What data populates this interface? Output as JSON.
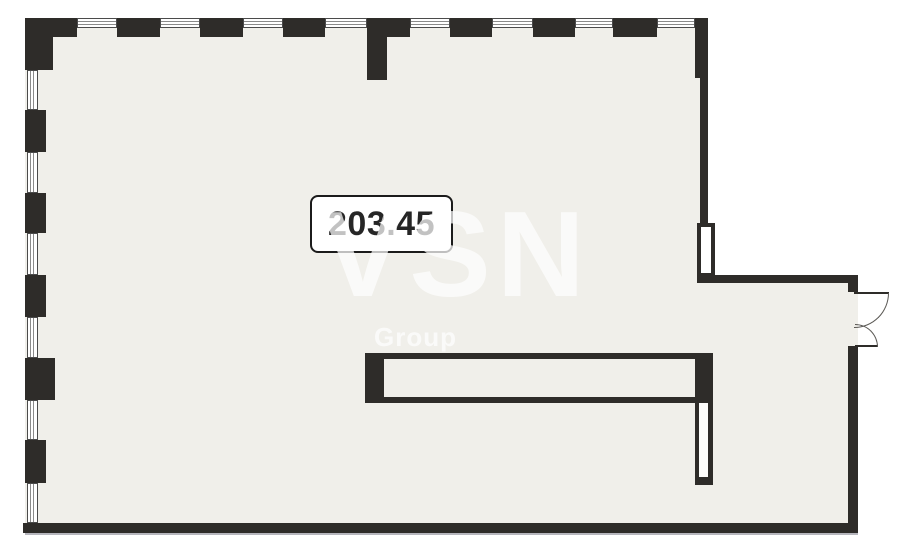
{
  "plan": {
    "area_label": "203.45",
    "watermark": {
      "line1": "VSN",
      "line2": "Group"
    },
    "colors": {
      "wall": "#2e2c29",
      "floor": "#f0efea",
      "outside": "#ffffff",
      "window_frame": "#4b4b4b",
      "window_line": "#8a8a8a",
      "shadow_line": "#b6b6bd",
      "arc_line": "#5a5854",
      "label_border": "#1b1b1b",
      "label_text": "#262626",
      "watermark": "#ffffff"
    },
    "floor_rects": [
      [
        25,
        18,
        683,
        515
      ],
      [
        697,
        275,
        161,
        258
      ]
    ],
    "wall_rects": [
      [
        25,
        18,
        52,
        19
      ],
      [
        25,
        18,
        28,
        52
      ],
      [
        117,
        18,
        43,
        19
      ],
      [
        200,
        18,
        43,
        19
      ],
      [
        283,
        18,
        42,
        19
      ],
      [
        367,
        18,
        43,
        19
      ],
      [
        367,
        37,
        20,
        43
      ],
      [
        450,
        18,
        42,
        19
      ],
      [
        533,
        18,
        42,
        19
      ],
      [
        613,
        18,
        44,
        19
      ],
      [
        695,
        18,
        13,
        60
      ],
      [
        700,
        78,
        8,
        146
      ],
      [
        25,
        110,
        21,
        42
      ],
      [
        25,
        193,
        21,
        40
      ],
      [
        25,
        275,
        21,
        42
      ],
      [
        25,
        358,
        30,
        42
      ],
      [
        25,
        440,
        21,
        43
      ],
      [
        697,
        275,
        161,
        8
      ],
      [
        848,
        275,
        10,
        17
      ],
      [
        848,
        346,
        10,
        187
      ],
      [
        23,
        523,
        835,
        10
      ],
      [
        365,
        353,
        19,
        50
      ],
      [
        695,
        353,
        18,
        50
      ]
    ],
    "windows_top": [
      [
        77,
        18,
        40,
        10
      ],
      [
        160,
        18,
        40,
        10
      ],
      [
        243,
        18,
        40,
        10
      ],
      [
        325,
        18,
        42,
        10
      ],
      [
        410,
        18,
        40,
        10
      ],
      [
        492,
        18,
        41,
        10
      ],
      [
        575,
        18,
        38,
        10
      ],
      [
        657,
        18,
        38,
        10
      ]
    ],
    "windows_left": [
      [
        27,
        70,
        11,
        40
      ],
      [
        27,
        152,
        11,
        41
      ],
      [
        27,
        233,
        11,
        42
      ],
      [
        27,
        317,
        11,
        41
      ],
      [
        27,
        400,
        11,
        40
      ],
      [
        27,
        483,
        11,
        40
      ]
    ],
    "door_jamb_rect": [
      697,
      223,
      18,
      54
    ],
    "counter_bar_rect": [
      365,
      353,
      348,
      50
    ],
    "pillar_rect": [
      695,
      403,
      18,
      82
    ],
    "shadow_rect": [
      25,
      533,
      833,
      2
    ],
    "door": {
      "top_leaf_line": [
        854,
        292,
        35,
        2
      ],
      "top_swing_arc": [
        854,
        293,
        35,
        35
      ],
      "bottom_leaf_line": [
        855,
        345,
        23,
        2
      ],
      "bottom_swing_arc": [
        855,
        324,
        23,
        23
      ]
    }
  }
}
